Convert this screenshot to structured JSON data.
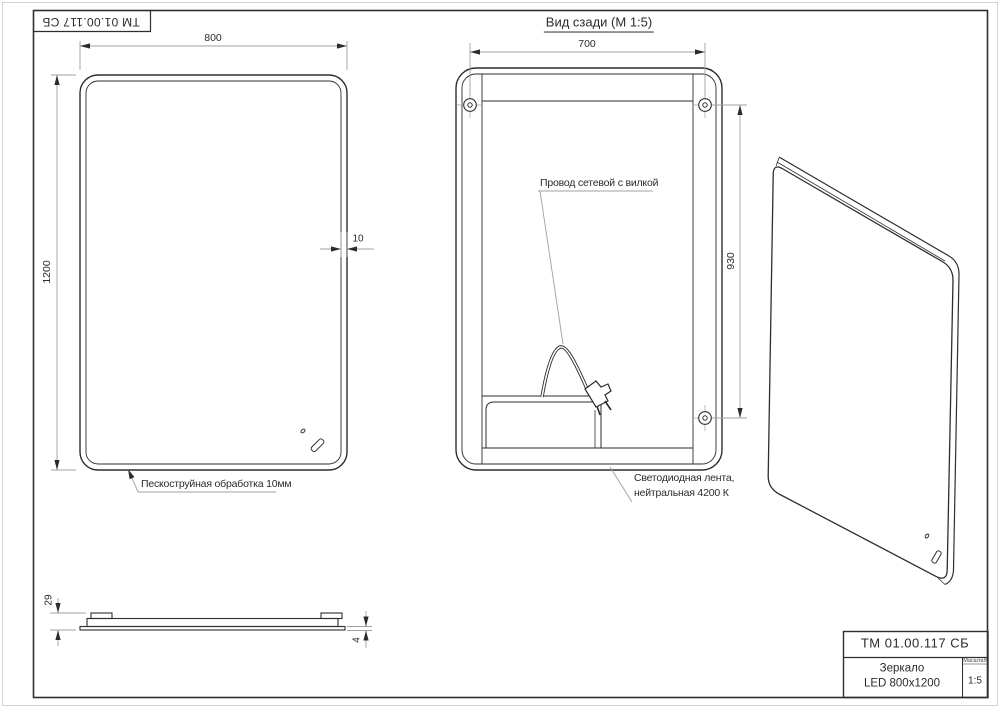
{
  "stamp": {
    "doc_number_rotated": "ТМ 01.00.117 СБ"
  },
  "back_view": {
    "title": "Вид сзади (М 1:5)",
    "dim_screw_spacing_horizontal": "700",
    "dim_screw_spacing_vertical": "930",
    "note_cord": "Провод сетевой с вилкой",
    "note_led_line1": "Светодиодная лента,",
    "note_led_line2": "нейтральная 4200 К"
  },
  "front_view": {
    "dim_width": "800",
    "dim_height": "1200",
    "dim_edge": "10",
    "note_sandblast": "Пескоструйная обработка 10мм"
  },
  "profile_view": {
    "dim_total_thickness": "29",
    "dim_glass_thickness": "4"
  },
  "title_block": {
    "doc_number": "ТМ 01.00.117 СБ",
    "name_line1": "Зеркало",
    "name_line2": "LED 800x1200",
    "scale_label": "Масштаб",
    "scale_value": "1:5"
  },
  "colors": {
    "line_main": "#2e2e2e",
    "line_dim": "#a0a0a0",
    "text": "#2b2b2b",
    "background": "#ffffff"
  }
}
